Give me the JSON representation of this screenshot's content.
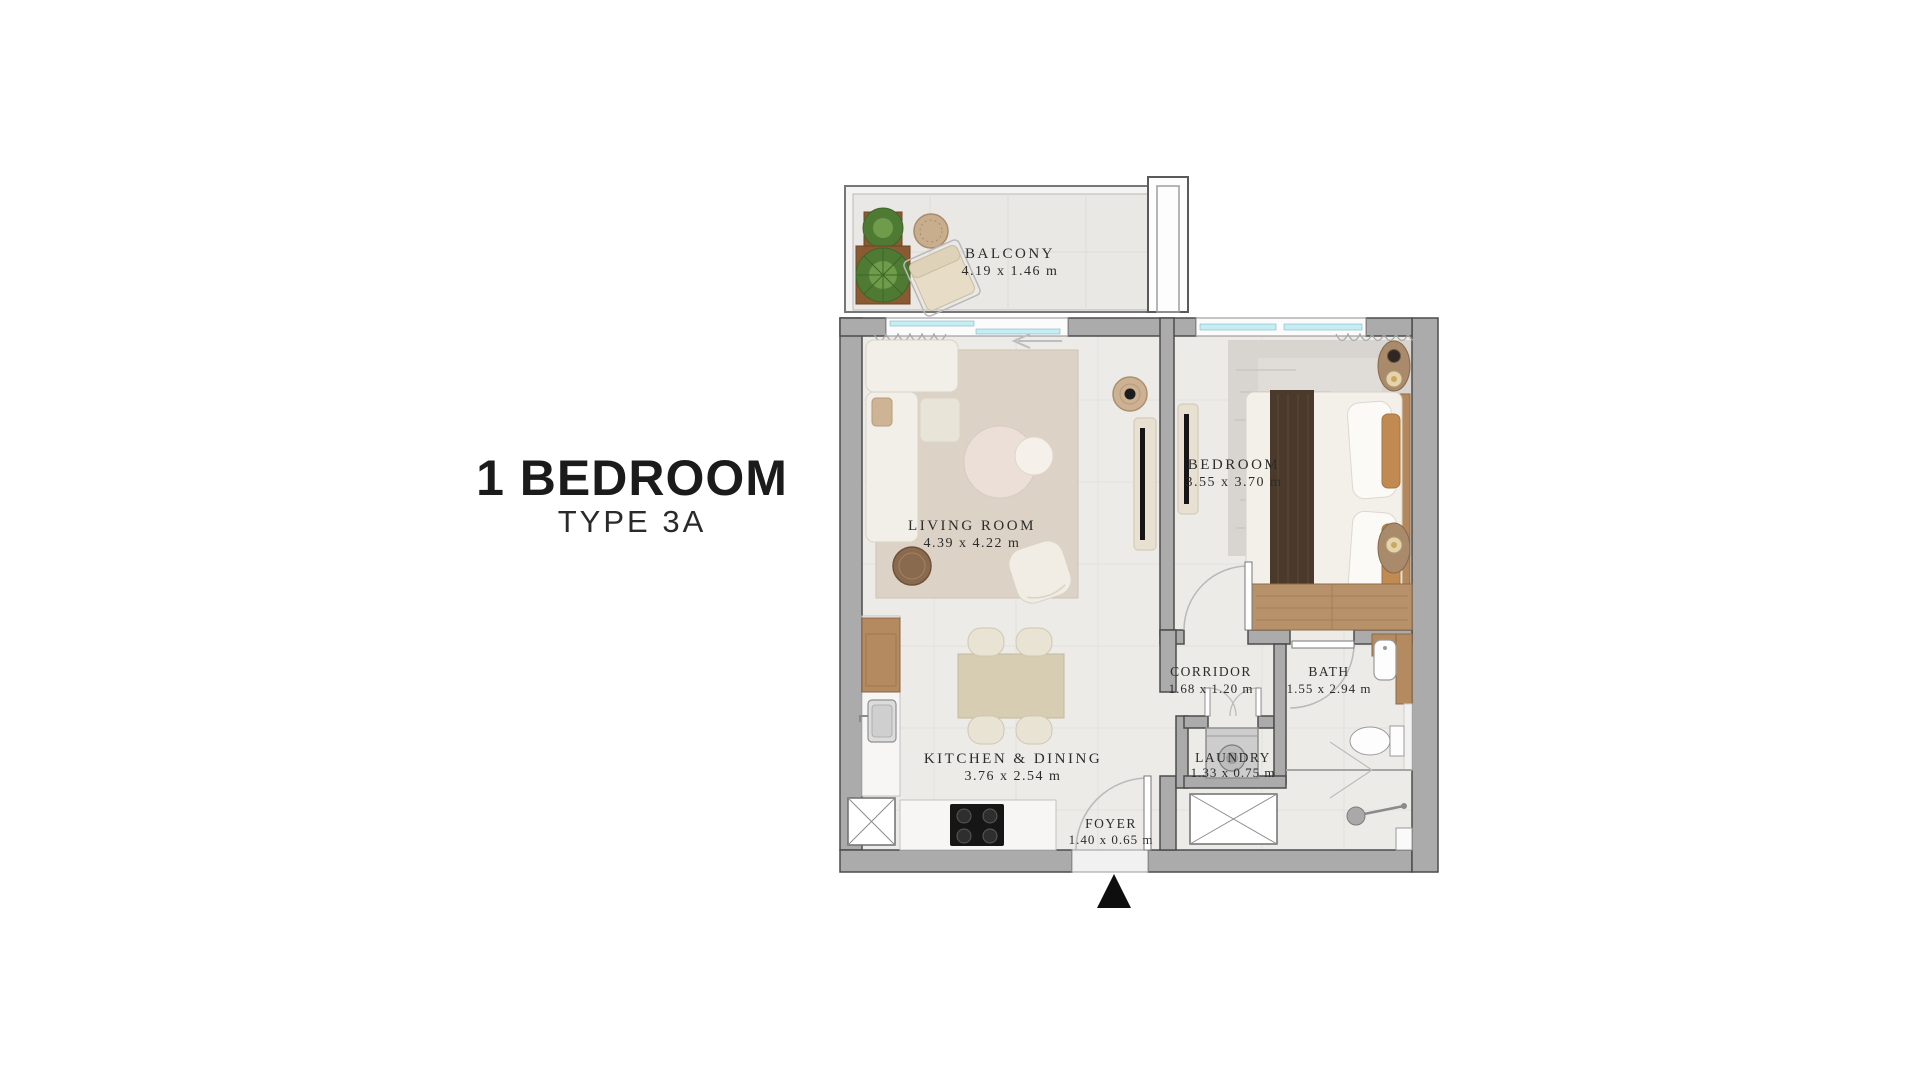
{
  "title": {
    "main": "1 BEDROOM",
    "sub": "TYPE 3A"
  },
  "rooms": [
    {
      "name": "BALCONY",
      "dims": "4.19 x 1.46 m"
    },
    {
      "name": "LIVING ROOM",
      "dims": "4.39 x 4.22 m"
    },
    {
      "name": "BEDROOM",
      "dims": "3.55 x 3.70 m"
    },
    {
      "name": "KITCHEN & DINING",
      "dims": "3.76 x 2.54 m"
    },
    {
      "name": "CORRIDOR",
      "dims": "1.68 x 1.20 m"
    },
    {
      "name": "BATH",
      "dims": "1.55 x 2.94 m"
    },
    {
      "name": "LAUNDRY",
      "dims": "1.33 x 0.75 m"
    },
    {
      "name": "FOYER",
      "dims": "1.40 x 0.65 m"
    }
  ],
  "icons": {
    "north_arrow": "north-arrow-icon"
  },
  "colors": {
    "wall": "#ababab",
    "wall_outline": "#4c4c4c",
    "floor": "#edebe8",
    "balcony_floor": "#e9e8e5",
    "glazing": "#c6ecf4",
    "wood": "#b48a60",
    "rug": "#dcd3c6",
    "plant_green": "#4e7a33",
    "label_text": "#2c2c2c",
    "title_text": "#1b1b1b",
    "north_arrow": "#0e0e0e"
  }
}
